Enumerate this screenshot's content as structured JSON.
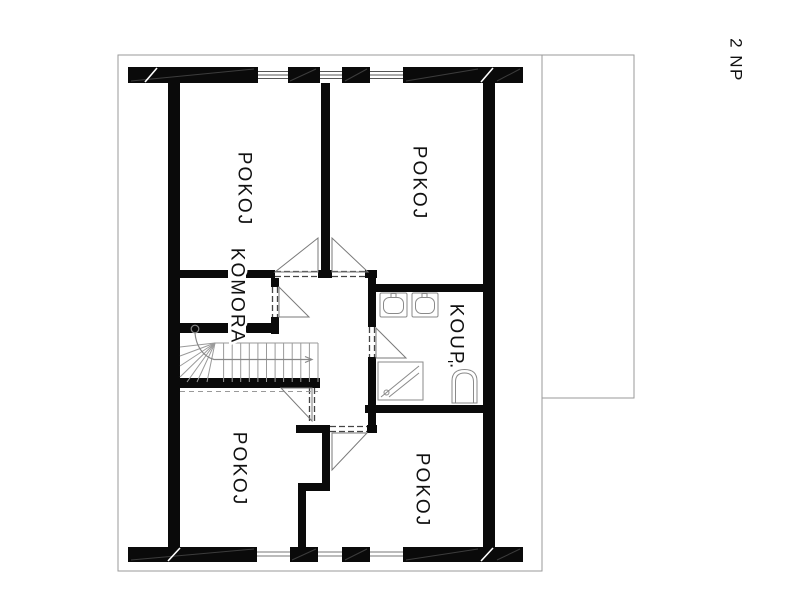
{
  "floor_plan": {
    "floor_label": "2 NP",
    "rooms": {
      "room_top_left": "POKOJ",
      "room_top_right": "POKOJ",
      "closet": "KOMORA",
      "bathroom": "KOUP.",
      "room_bottom_left": "POKOJ",
      "room_bottom_right": "POKOJ"
    },
    "icons": [
      "washbasin-icon",
      "washbasin-icon",
      "shower-icon",
      "toilet-icon",
      "staircase-icon",
      "door-swing-icon"
    ],
    "colors": {
      "wall": "#0a0a0a",
      "outline": "#9a9a9a",
      "background": "#ffffff",
      "text": "#111111"
    }
  }
}
